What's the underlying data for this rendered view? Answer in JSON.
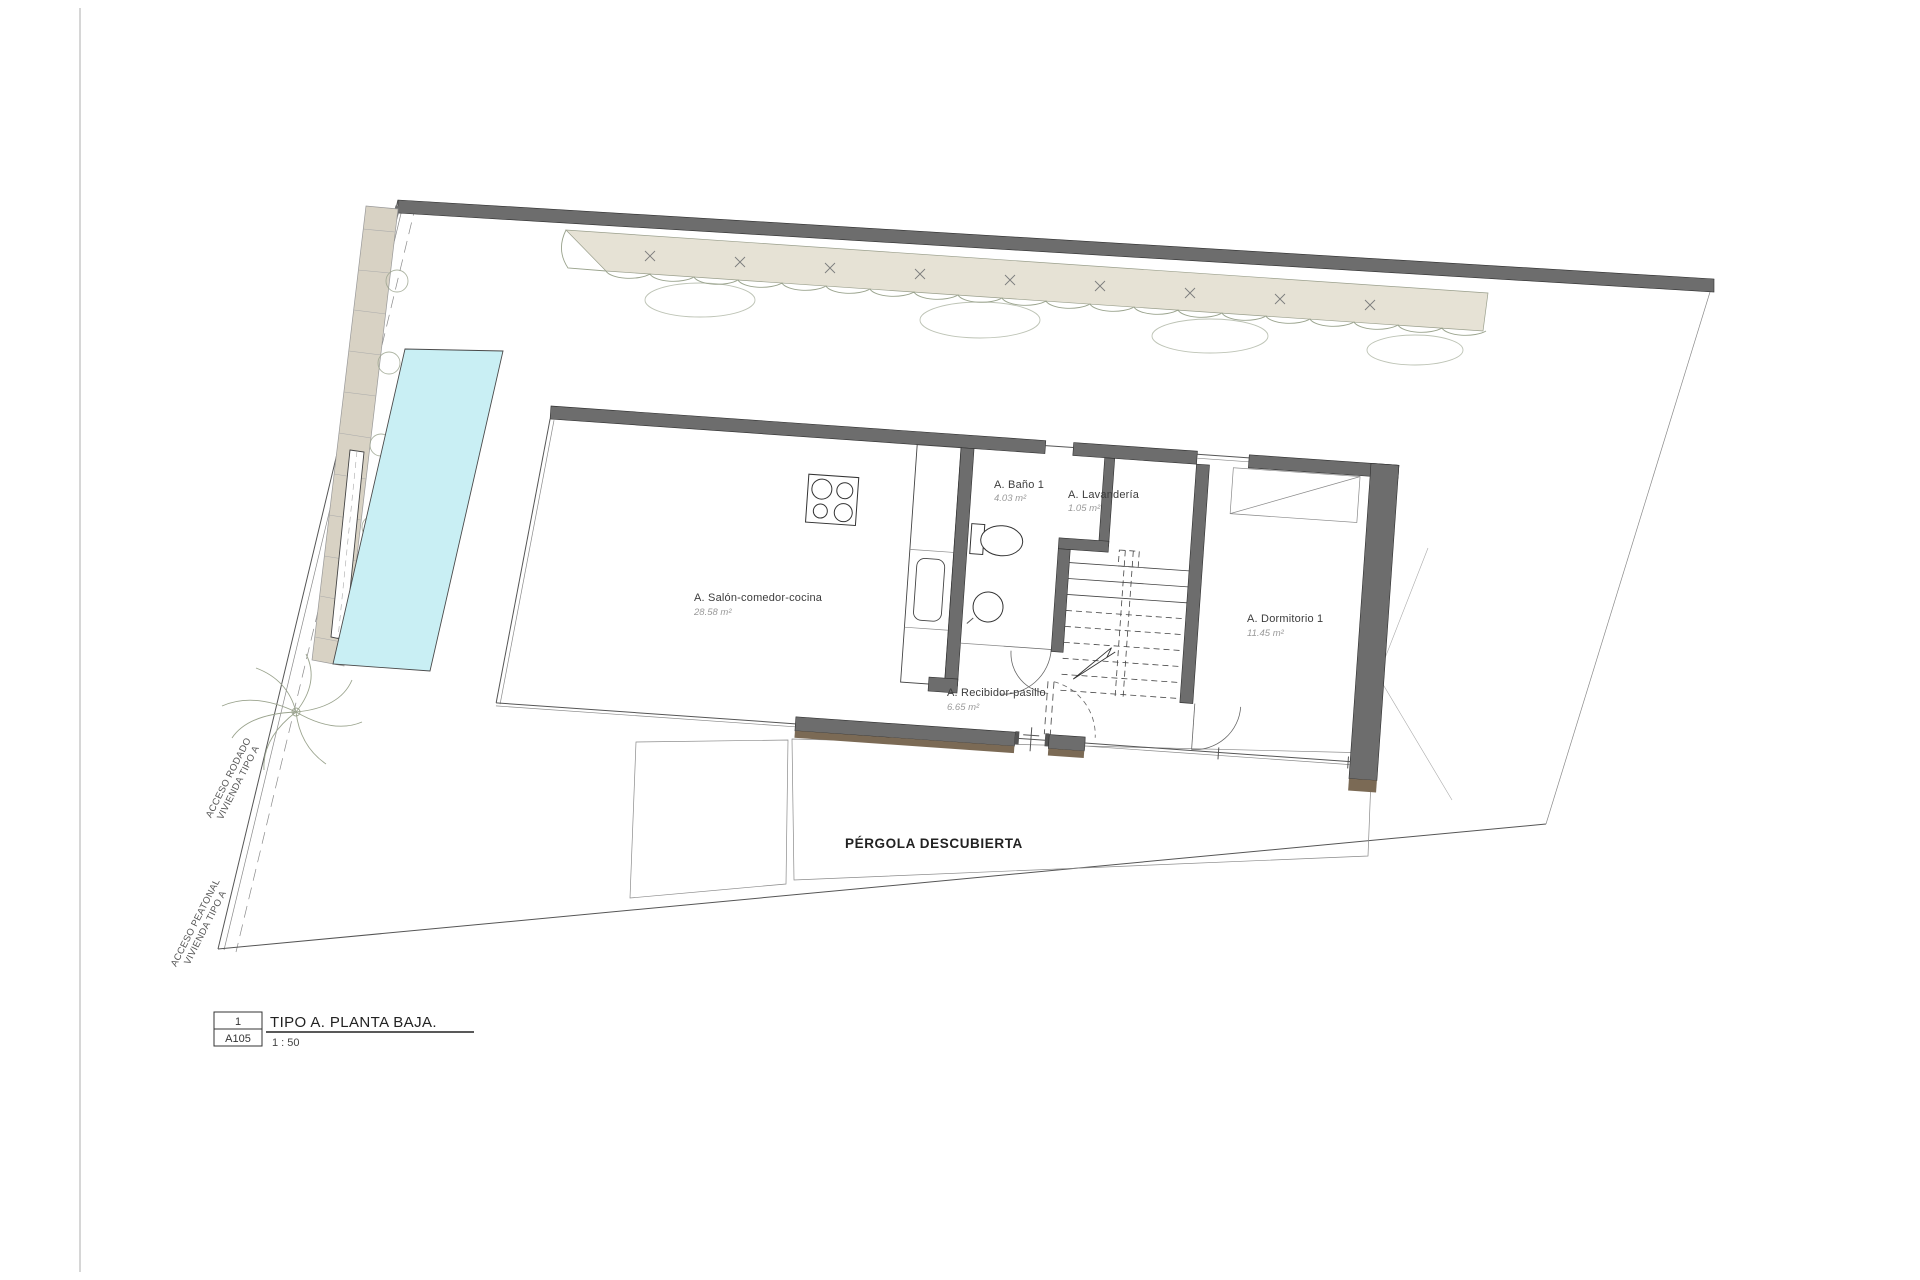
{
  "drawing": {
    "sheet": {
      "number": "1",
      "code": "A105",
      "title": "TIPO A. PLANTA BAJA.",
      "scale": "1 : 50"
    },
    "rooms": {
      "salon": {
        "name": "A. Salón-comedor-cocina",
        "area": "28.58 m²"
      },
      "bano1": {
        "name": "A. Baño 1",
        "area": "4.03 m²"
      },
      "lavanderia": {
        "name": "A. Lavandería",
        "area": "1.05 m²"
      },
      "dormitorio1": {
        "name": "A. Dormitorio 1",
        "area": "11.45 m²"
      },
      "recibidor": {
        "name": "A. Recibidor-pasillo",
        "area": "6.65 m²"
      }
    },
    "outdoor": {
      "pergola": "PÉRGOLA DESCUBIERTA"
    },
    "access": {
      "rodado_line1": "ACCESO RODADO",
      "rodado_line2": "VIVIENDA TIPO A",
      "peatonal_line1": "ACCESO PEATONAL",
      "peatonal_line2": "VIVIENDA TIPO A"
    },
    "colors": {
      "wall": "#6d6d6d",
      "wall_shadow": "#7b6a55",
      "pool": "#c9eff4",
      "hedge": "#e6e2d5",
      "paving": "#d8d2c4"
    }
  }
}
